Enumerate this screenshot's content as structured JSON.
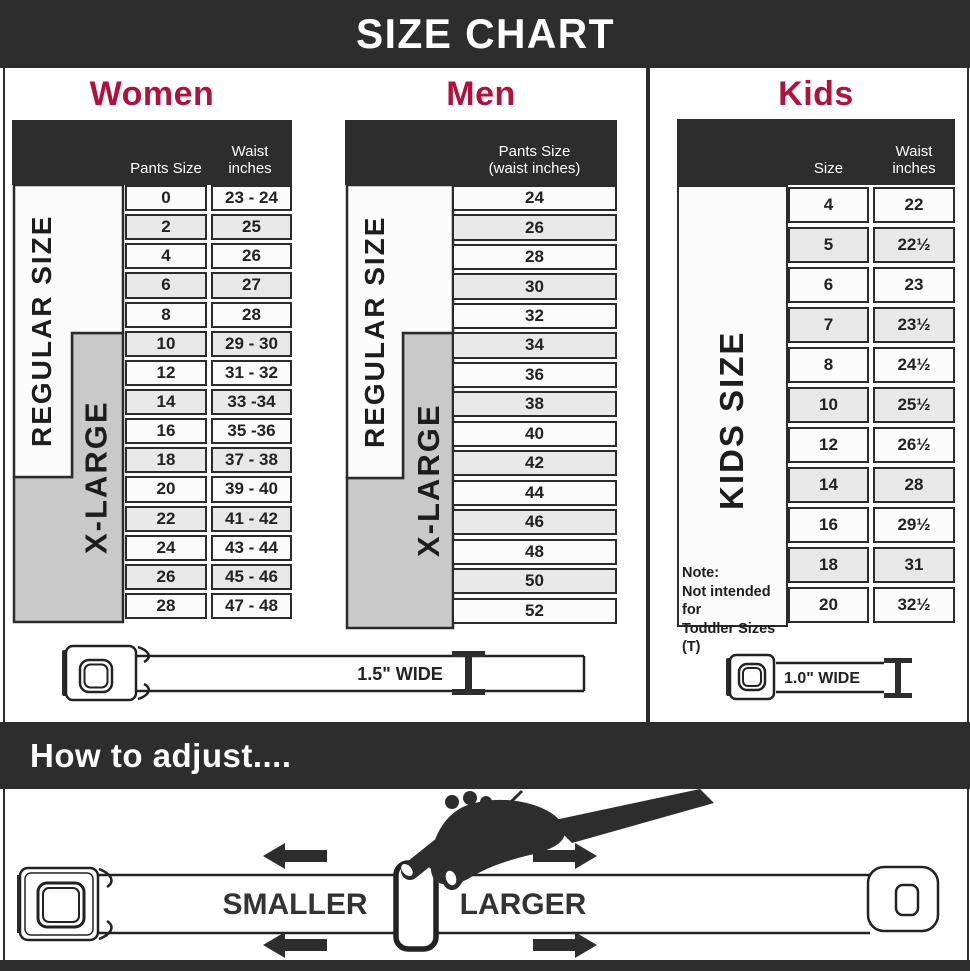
{
  "title": "SIZE CHART",
  "colors": {
    "accent_crimson": "#b0123e",
    "bar_dark": "#2d2d2d",
    "grid_dark": "#2b2b2b",
    "gray_block": "#c9c9c9",
    "row_light": "#fbfbfb",
    "row_alt": "#e8e8e8"
  },
  "women": {
    "title": "Women",
    "col_pants": "Pants Size",
    "col_waist": "Waist inches",
    "regular_label": "REGULAR SIZE",
    "xlarge_label": "X-LARGE",
    "rows": [
      [
        "0",
        "23 - 24"
      ],
      [
        "2",
        "25"
      ],
      [
        "4",
        "26"
      ],
      [
        "6",
        "27"
      ],
      [
        "8",
        "28"
      ],
      [
        "10",
        "29 - 30"
      ],
      [
        "12",
        "31 - 32"
      ],
      [
        "14",
        "33 -34"
      ],
      [
        "16",
        "35 -36"
      ],
      [
        "18",
        "37 - 38"
      ],
      [
        "20",
        "39 - 40"
      ],
      [
        "22",
        "41 - 42"
      ],
      [
        "24",
        "43 - 44"
      ],
      [
        "26",
        "45 - 46"
      ],
      [
        "28",
        "47 - 48"
      ]
    ]
  },
  "men": {
    "title": "Men",
    "col_header_line1": "Pants Size",
    "col_header_line2": "(waist inches)",
    "regular_label": "REGULAR SIZE",
    "xlarge_label": "X-LARGE",
    "rows": [
      "24",
      "26",
      "28",
      "30",
      "32",
      "34",
      "36",
      "38",
      "40",
      "42",
      "44",
      "46",
      "48",
      "50",
      "52"
    ]
  },
  "kids": {
    "title": "Kids",
    "col_size": "Size",
    "col_waist": "Waist inches",
    "label": "KIDS SIZE",
    "note_lines": [
      "Note:",
      "Not intended for",
      "Toddler Sizes (T)"
    ],
    "rows": [
      [
        "4",
        "22"
      ],
      [
        "5",
        "22½"
      ],
      [
        "6",
        "23"
      ],
      [
        "7",
        "23½"
      ],
      [
        "8",
        "24½"
      ],
      [
        "10",
        "25½"
      ],
      [
        "12",
        "26½"
      ],
      [
        "14",
        "28"
      ],
      [
        "16",
        "29½"
      ],
      [
        "18",
        "31"
      ],
      [
        "20",
        "32½"
      ]
    ]
  },
  "belts": {
    "adult_width_label": "1.5\" WIDE",
    "kids_width_label": "1.0\" WIDE"
  },
  "adjust": {
    "title": "How to adjust....",
    "smaller": "SMALLER",
    "larger": "LARGER"
  }
}
